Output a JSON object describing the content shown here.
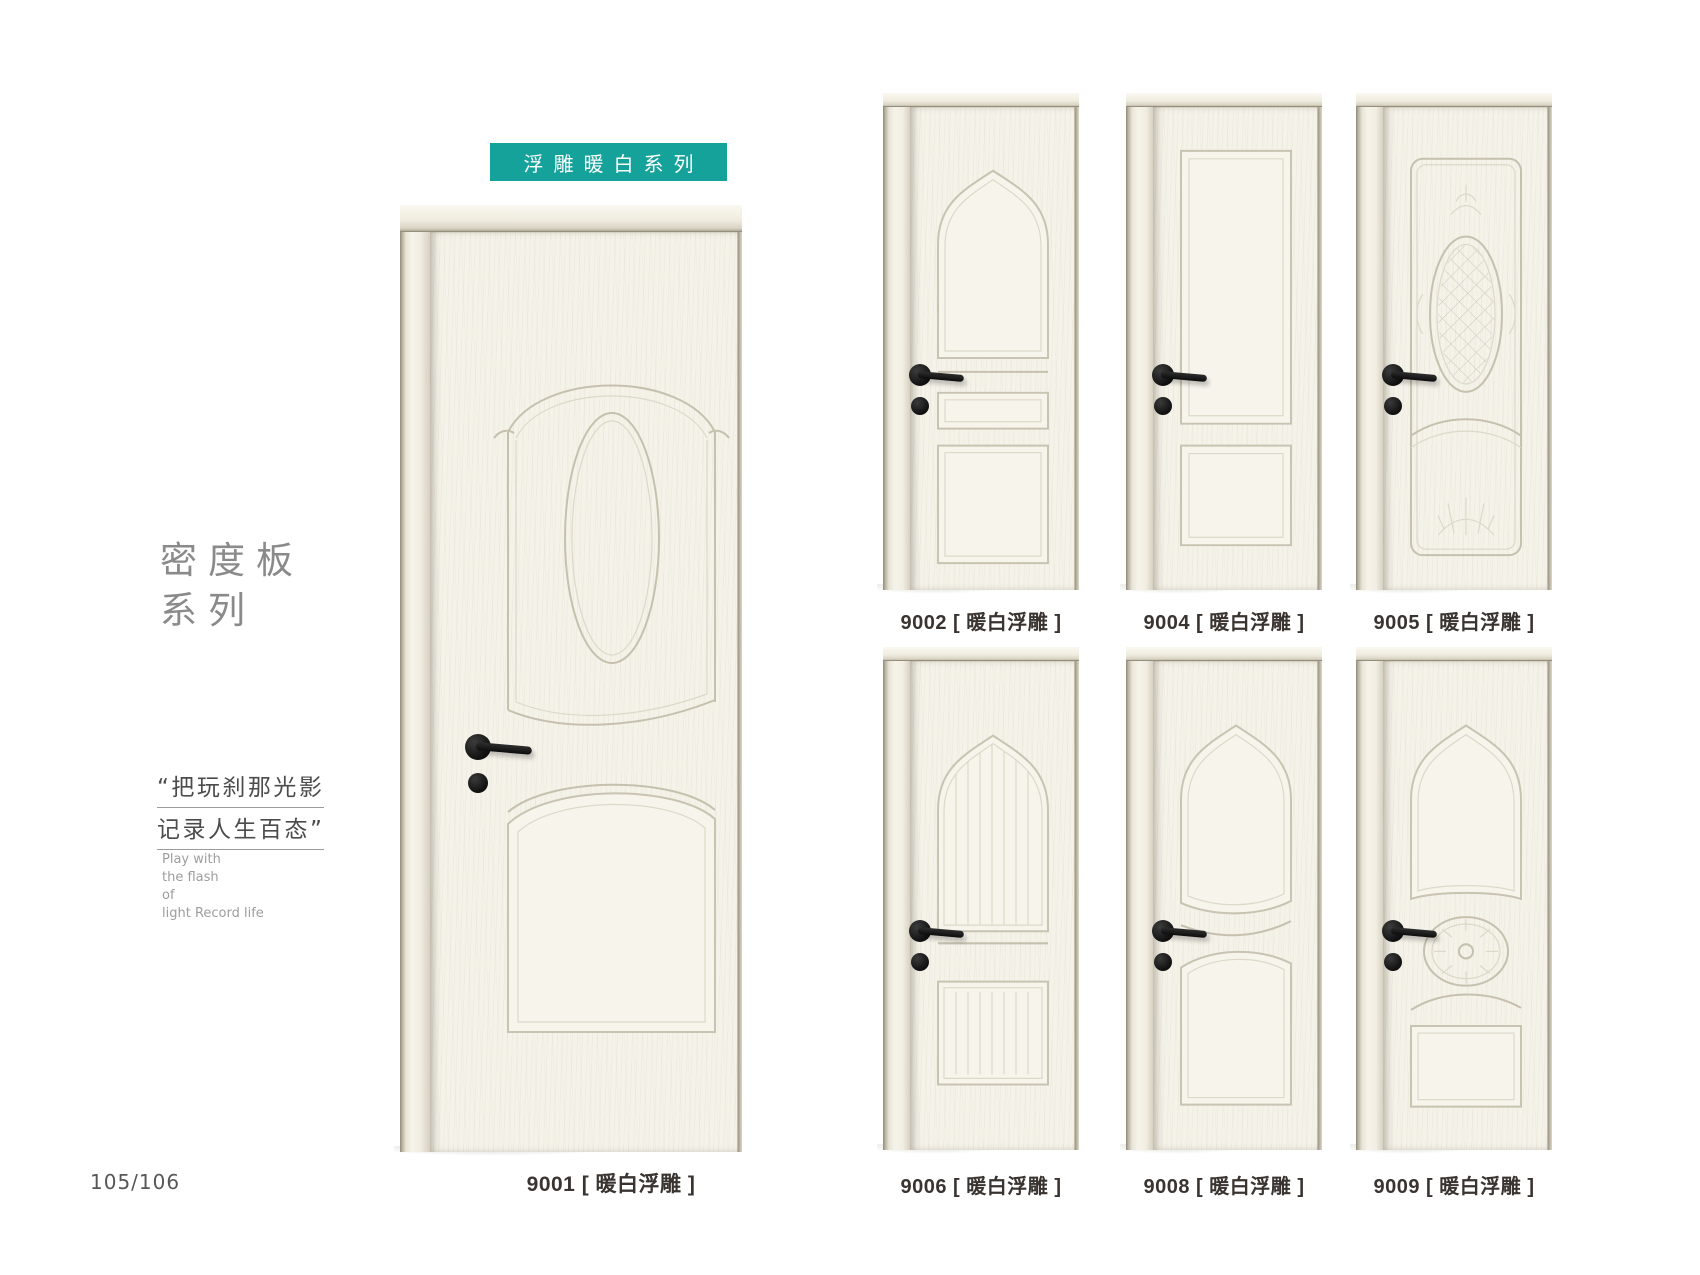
{
  "page": {
    "page_number": "105/106",
    "background": "#ffffff"
  },
  "banner": {
    "text": "浮雕暖白系列",
    "color": "#15a29a"
  },
  "category": {
    "line1": "密度板",
    "line2": "系列"
  },
  "quote": {
    "line1": "“把玩刹那光影",
    "line2": "记录人生百态”"
  },
  "tagline": {
    "line1": "Play with",
    "line2": "the flash",
    "line3": "of",
    "line4": "light Record life"
  },
  "colors": {
    "accent_teal": "#15a29a",
    "door_cream": "#f5f2e9",
    "handle_black": "#1a1a1a",
    "label_text": "#3a3431"
  },
  "featured_door": {
    "code": "9001",
    "label": "9001 [ 暖白浮雕 ]"
  },
  "doors": [
    {
      "code": "9002",
      "label": "9002 [ 暖白浮雕 ]"
    },
    {
      "code": "9004",
      "label": "9004 [ 暖白浮雕 ]"
    },
    {
      "code": "9005",
      "label": "9005 [ 暖白浮雕 ]"
    },
    {
      "code": "9006",
      "label": "9006 [ 暖白浮雕 ]"
    },
    {
      "code": "9008",
      "label": "9008 [ 暖白浮雕 ]"
    },
    {
      "code": "9009",
      "label": "9009 [ 暖白浮雕 ]"
    }
  ]
}
